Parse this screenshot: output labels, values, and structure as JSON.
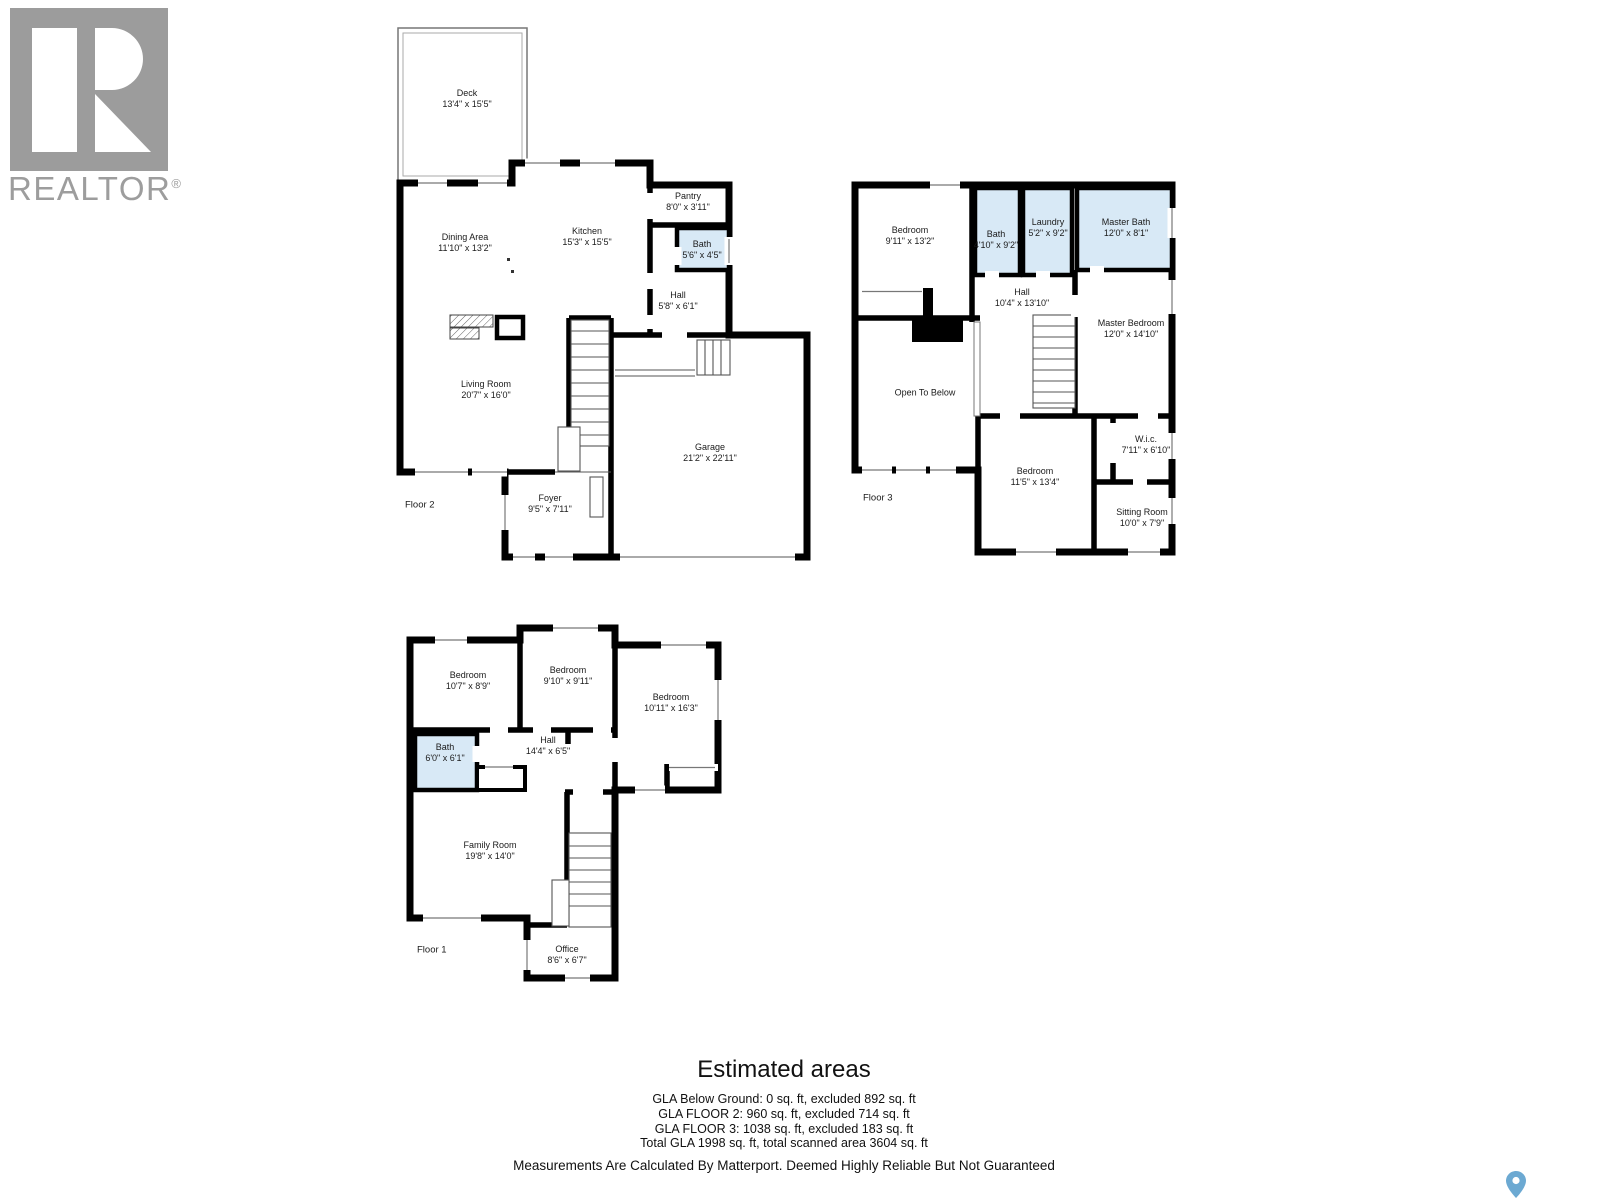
{
  "logo": {
    "brand": "REALTOR",
    "registered": "®"
  },
  "floors": [
    {
      "floor_label": "Floor 2",
      "rooms": [
        {
          "name": "Deck",
          "dims": "13'4\" x 15'5\""
        },
        {
          "name": "Dining Area",
          "dims": "11'10\" x 13'2\""
        },
        {
          "name": "Kitchen",
          "dims": "15'3\" x 15'5\""
        },
        {
          "name": "Pantry",
          "dims": "8'0\" x 3'11\""
        },
        {
          "name": "Bath",
          "dims": "5'6\" x 4'5\""
        },
        {
          "name": "Hall",
          "dims": "5'8\" x 6'1\""
        },
        {
          "name": "Living Room",
          "dims": "20'7\" x 16'0\""
        },
        {
          "name": "Foyer",
          "dims": "9'5\" x 7'11\""
        },
        {
          "name": "Garage",
          "dims": "21'2\" x 22'11\""
        }
      ]
    },
    {
      "floor_label": "Floor 3",
      "rooms": [
        {
          "name": "Bedroom",
          "dims": "9'11\" x 13'2\""
        },
        {
          "name": "Bath",
          "dims": "4'10\" x 9'2\""
        },
        {
          "name": "Laundry",
          "dims": "5'2\" x 9'2\""
        },
        {
          "name": "Master Bath",
          "dims": "12'0\" x 8'1\""
        },
        {
          "name": "Hall",
          "dims": "10'4\" x 13'10\""
        },
        {
          "name": "Master Bedroom",
          "dims": "12'0\" x 14'10\""
        },
        {
          "name": "Open To Below",
          "dims": ""
        },
        {
          "name": "Bedroom",
          "dims": "11'5\" x 13'4\""
        },
        {
          "name": "W.i.c.",
          "dims": "7'11\" x 6'10\""
        },
        {
          "name": "Sitting Room",
          "dims": "10'0\" x 7'9\""
        }
      ]
    },
    {
      "floor_label": "Floor 1",
      "rooms": [
        {
          "name": "Bedroom",
          "dims": "10'7\" x 8'9\""
        },
        {
          "name": "Bedroom",
          "dims": "9'10\" x 9'11\""
        },
        {
          "name": "Bedroom",
          "dims": "10'11\" x 16'3\""
        },
        {
          "name": "Bath",
          "dims": "6'0\" x 6'1\""
        },
        {
          "name": "Hall",
          "dims": "14'4\" x 6'5\""
        },
        {
          "name": "Family Room",
          "dims": "19'8\" x 14'0\""
        },
        {
          "name": "Office",
          "dims": "8'6\" x 6'7\""
        }
      ]
    }
  ],
  "estimated_areas": {
    "title": "Estimated areas",
    "lines": [
      "GLA Below Ground: 0 sq. ft, excluded 892 sq. ft",
      "GLA FLOOR 2: 960 sq. ft, excluded 714 sq. ft",
      "GLA FLOOR 3: 1038 sq. ft, excluded 183 sq. ft",
      "Total GLA 1998 sq. ft, total scanned area 3604 sq. ft"
    ]
  },
  "disclaimer": "Measurements Are Calculated By Matterport. Deemed Highly Reliable But Not Guaranteed",
  "colors": {
    "wall": "#000000",
    "wet_room_fill": "#D8E9F6",
    "logo_gray": "#9C9C9C",
    "pin_blue": "#6CA9D2"
  },
  "icons": {
    "pin": "map-pin-icon"
  }
}
